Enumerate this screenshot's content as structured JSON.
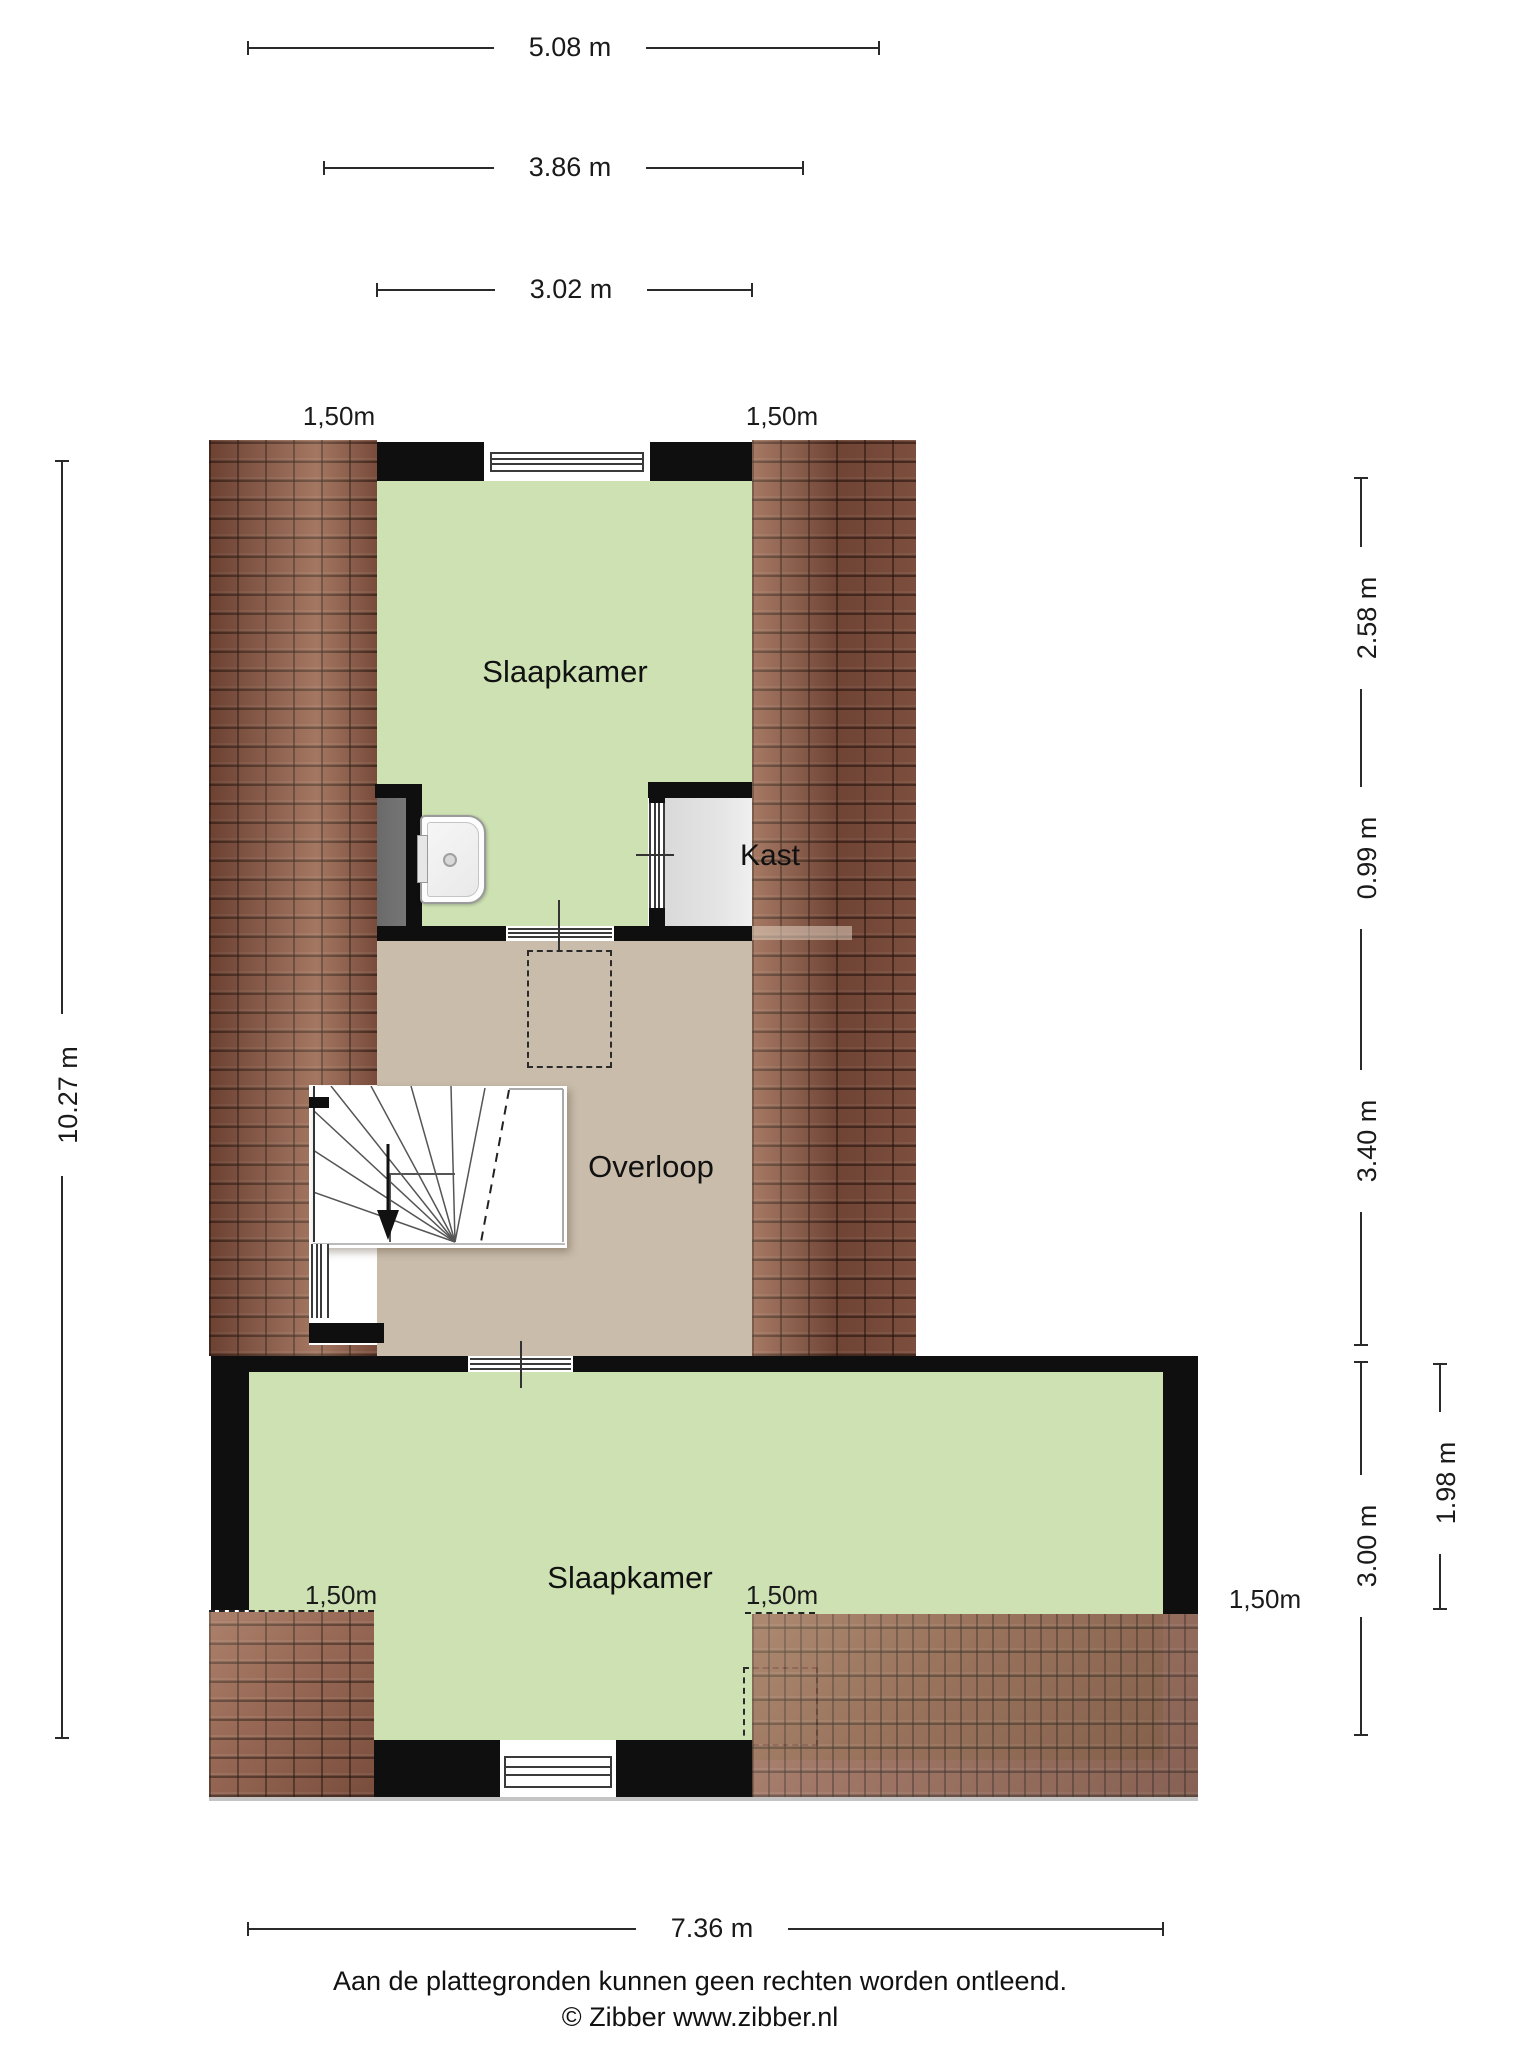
{
  "meta": {
    "title": "Floor plan - verdieping (attic floor)",
    "source_note": "Zibber plattegrond"
  },
  "colors": {
    "page_bg": "#ffffff",
    "room_green": "#cde1b3",
    "floor_tan": "#c9bcab",
    "closet_gray": "#e4e4e4",
    "shower_gray": "#777777",
    "wall_black": "#0f0f0f",
    "tile_brown": "#8a5947",
    "dim_text": "#1a1a1a"
  },
  "rooms": {
    "bedroom_top": "Slaapkamer",
    "closet": "Kast",
    "landing": "Overloop",
    "bedroom_bottom": "Slaapkamer"
  },
  "knee_wall": {
    "height_label": "1,50m",
    "count_visible": 5
  },
  "dims": {
    "top_1": "5.08 m",
    "top_2": "3.86 m",
    "top_3": "3.02 m",
    "left_1": "10.27 m",
    "right_1": "2.58 m",
    "right_2": "0.99 m",
    "right_3": "3.40 m",
    "right_4": "3.00 m",
    "right_outer": "1.98 m",
    "bottom_1": "7.36 m"
  },
  "footer": {
    "disclaimer": "Aan de plattegronden kunnen geen rechten worden ontleend.",
    "copyright": "© Zibber www.zibber.nl"
  }
}
